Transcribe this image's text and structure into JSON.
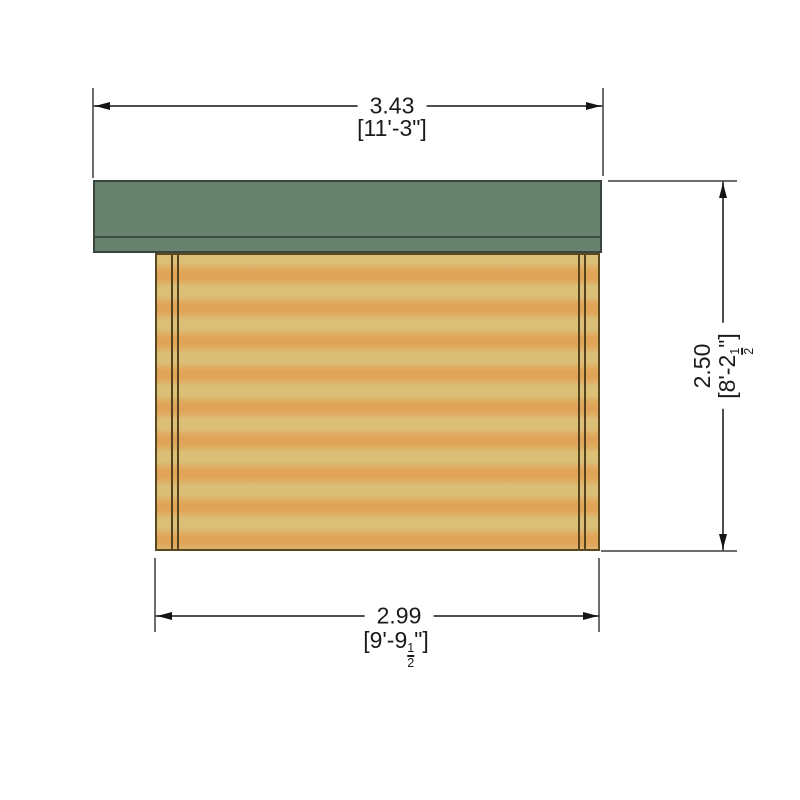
{
  "diagram": {
    "type": "shed-side-elevation",
    "colors": {
      "roof_green": "#68816f",
      "roof_outline": "#3a463c",
      "wood_light": "#dbbf76",
      "wood_dark": "#e0a458",
      "wall_outline": "#5a4820",
      "dim_line": "#4f4f4f",
      "text": "#1b1b1b",
      "background": "#ffffff"
    },
    "dimensions": {
      "overall_width": {
        "metric": "3.43",
        "imperial": "[11'-3\"]"
      },
      "overall_height": {
        "metric": "2.50",
        "imperial_pre": "[8'-2",
        "frac_num": "1",
        "frac_den": "2",
        "imperial_post": "\"]"
      },
      "base_width": {
        "metric": "2.99",
        "imperial_pre": "[9'-9",
        "frac_num": "1",
        "frac_den": "2",
        "imperial_post": "\"]"
      }
    }
  }
}
